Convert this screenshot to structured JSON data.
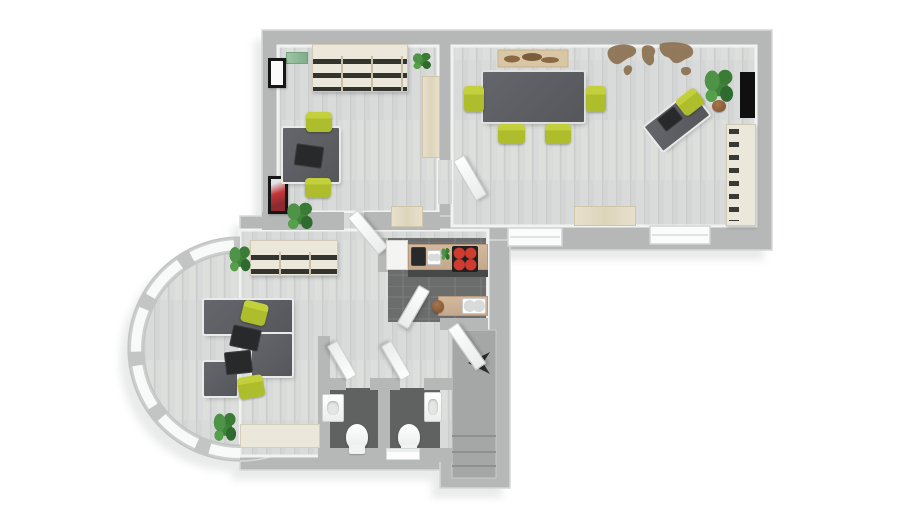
{
  "palette": {
    "bg": "#ffffff",
    "shadow": "#e9eaea",
    "wall": "#b6b8b7",
    "wall-edge": "#d7d8d7",
    "floor": "#d9dbda",
    "floor-stripe": "#cfd1d0",
    "dark-floor": "#6b6d6d",
    "bath-floor": "#606262",
    "stair": "#a5a7a6",
    "desk": "#55575b",
    "desk-rim": "#e9eaea",
    "lime": "#aebd2c",
    "cream": "#ebe7da",
    "wood": "#ddd4bb",
    "slot": "#34342e",
    "map": "#8b6f4e",
    "red": "#b03236",
    "tan": "#c5a98c",
    "stove": "#202022",
    "burner": "#cf3b2f",
    "green": "#3f8539",
    "pot": "#7a4e2d",
    "door": "#f6f7f7"
  },
  "scene": {
    "furniture": [
      {
        "name": "office1-wall-shelf",
        "cls": "binder-shelf",
        "x": 312,
        "y": 44,
        "w": 96,
        "h": 48
      },
      {
        "name": "office1-wall-plant-left",
        "cls": "wallgreen",
        "x": 286,
        "y": 52,
        "w": 22,
        "h": 12
      },
      {
        "name": "office1-wall-plant-right",
        "cls": "plant",
        "x": 410,
        "y": 50,
        "w": 24,
        "h": 22
      },
      {
        "name": "office1-frame-top",
        "cls": "frame",
        "x": 268,
        "y": 58,
        "w": 18,
        "h": 30
      },
      {
        "name": "office1-frame-bottom",
        "cls": "frame frame-red",
        "x": 268,
        "y": 176,
        "w": 20,
        "h": 38
      },
      {
        "name": "office1-cabinet",
        "cls": "wood",
        "x": 422,
        "y": 76,
        "w": 18,
        "h": 82
      },
      {
        "name": "office1-desk",
        "cls": "desk",
        "x": 283,
        "y": 128,
        "w": 56,
        "h": 54
      },
      {
        "name": "office1-desk-monitor",
        "cls": "laptop",
        "x": 296,
        "y": 146,
        "w": 26,
        "h": 20,
        "rot": 8
      },
      {
        "name": "office1-chair-top",
        "cls": "chair",
        "x": 306,
        "y": 112,
        "w": 26,
        "h": 20
      },
      {
        "name": "office1-chair-bottom",
        "cls": "chair",
        "x": 305,
        "y": 178,
        "w": 26,
        "h": 20
      },
      {
        "name": "office1-plant",
        "cls": "plant",
        "x": 283,
        "y": 198,
        "w": 34,
        "h": 36
      },
      {
        "name": "office1-door",
        "cls": "door",
        "x": 346,
        "y": 214,
        "w": 13,
        "h": 48,
        "rot": -40
      },
      {
        "name": "conference-table",
        "cls": "desk table",
        "x": 483,
        "y": 72,
        "w": 101,
        "h": 50
      },
      {
        "name": "conference-chair-left",
        "cls": "chair",
        "x": 464,
        "y": 86,
        "w": 20,
        "h": 26
      },
      {
        "name": "conference-chair-right",
        "cls": "chair",
        "x": 586,
        "y": 86,
        "w": 20,
        "h": 26
      },
      {
        "name": "conference-chair-bottom1",
        "cls": "chair",
        "x": 498,
        "y": 124,
        "w": 27,
        "h": 20
      },
      {
        "name": "conference-chair-bottom2",
        "cls": "chair",
        "x": 545,
        "y": 124,
        "w": 26,
        "h": 20
      },
      {
        "name": "conference-desk",
        "cls": "desk",
        "x": 648,
        "y": 106,
        "w": 58,
        "h": 30,
        "rot": -38
      },
      {
        "name": "conference-desk-laptop",
        "cls": "laptop",
        "x": 660,
        "y": 112,
        "w": 20,
        "h": 14,
        "rot": -38
      },
      {
        "name": "conference-desk-chair",
        "cls": "chair",
        "x": 678,
        "y": 92,
        "w": 24,
        "h": 20,
        "rot": -38
      },
      {
        "name": "conference-plant",
        "cls": "plant",
        "x": 700,
        "y": 64,
        "w": 38,
        "h": 44
      },
      {
        "name": "conference-plant-pot",
        "cls": "pot",
        "x": 712,
        "y": 100,
        "w": 14,
        "h": 12
      },
      {
        "name": "conference-art-red",
        "cls": "frame-redart",
        "x": 740,
        "y": 72,
        "w": 15,
        "h": 46
      },
      {
        "name": "conference-credenza",
        "cls": "binder-shelf-v",
        "x": 726,
        "y": 124,
        "w": 30,
        "h": 102
      },
      {
        "name": "conference-sideboard",
        "cls": "wood",
        "x": 574,
        "y": 206,
        "w": 62,
        "h": 20
      },
      {
        "name": "conference-door",
        "cls": "door",
        "x": 452,
        "y": 158,
        "w": 13,
        "h": 46,
        "rot": -30
      },
      {
        "name": "hall-sideboard",
        "cls": "wood",
        "x": 391,
        "y": 206,
        "w": 32,
        "h": 21
      },
      {
        "name": "kitchen-fridge",
        "cls": "appliance",
        "x": 386,
        "y": 240,
        "w": 22,
        "h": 30
      },
      {
        "name": "kitchen-counter",
        "cls": "counter",
        "x": 408,
        "y": 244,
        "w": 80,
        "h": 26
      },
      {
        "name": "kitchen-counter-front",
        "cls": "counter-front",
        "x": 408,
        "y": 270,
        "w": 80,
        "h": 7
      },
      {
        "name": "kitchen-coffee-machine",
        "cls": "laptop",
        "x": 412,
        "y": 248,
        "w": 13,
        "h": 17
      },
      {
        "name": "kitchen-bowls",
        "cls": "sink",
        "x": 427,
        "y": 250,
        "w": 14,
        "h": 15
      },
      {
        "name": "kitchen-herb-plant",
        "cls": "plant",
        "x": 440,
        "y": 246,
        "w": 11,
        "h": 16
      },
      {
        "name": "kitchen-stove",
        "cls": "stove",
        "x": 452,
        "y": 246,
        "w": 26,
        "h": 26
      },
      {
        "name": "kitchen-sink-counter",
        "cls": "counter",
        "x": 438,
        "y": 296,
        "w": 50,
        "h": 20
      },
      {
        "name": "kitchen-sink",
        "cls": "sink",
        "x": 462,
        "y": 298,
        "w": 24,
        "h": 16
      },
      {
        "name": "kitchen-jar",
        "cls": "pot",
        "x": 432,
        "y": 300,
        "w": 12,
        "h": 13
      },
      {
        "name": "kitchen-door",
        "cls": "door",
        "x": 418,
        "y": 288,
        "w": 13,
        "h": 44,
        "rot": 30
      },
      {
        "name": "bath1-sink",
        "cls": "sink-unit",
        "x": 322,
        "y": 394,
        "w": 22,
        "h": 28
      },
      {
        "name": "bath1-toilet",
        "cls": "toilet",
        "x": 346,
        "y": 424,
        "w": 22,
        "h": 26
      },
      {
        "name": "bath1-door",
        "cls": "door",
        "x": 346,
        "y": 378,
        "w": 12,
        "h": 40,
        "rot": 150
      },
      {
        "name": "bath2-sink",
        "cls": "sink-unit",
        "x": 424,
        "y": 392,
        "w": 18,
        "h": 30
      },
      {
        "name": "bath2-toilet",
        "cls": "toilet",
        "x": 398,
        "y": 424,
        "w": 22,
        "h": 26
      },
      {
        "name": "bath2-door",
        "cls": "door",
        "x": 400,
        "y": 378,
        "w": 12,
        "h": 40,
        "rot": 150
      },
      {
        "name": "bath-bench",
        "cls": "mat",
        "x": 386,
        "y": 448,
        "w": 34,
        "h": 12
      },
      {
        "name": "lounge-sideboard-top",
        "cls": "binder-shelf",
        "x": 250,
        "y": 240,
        "w": 88,
        "h": 36
      },
      {
        "name": "lounge-plant-top",
        "cls": "plant",
        "x": 226,
        "y": 242,
        "w": 28,
        "h": 34
      },
      {
        "name": "lounge-desk-main",
        "cls": "desk",
        "x": 204,
        "y": 300,
        "w": 88,
        "h": 34
      },
      {
        "name": "lounge-desk-right",
        "cls": "desk",
        "x": 252,
        "y": 334,
        "w": 40,
        "h": 42
      },
      {
        "name": "lounge-desk-left",
        "cls": "desk",
        "x": 204,
        "y": 362,
        "w": 33,
        "h": 34
      },
      {
        "name": "lounge-laptop1",
        "cls": "laptop",
        "x": 232,
        "y": 328,
        "w": 27,
        "h": 20,
        "rot": 12
      },
      {
        "name": "lounge-laptop2",
        "cls": "laptop",
        "x": 226,
        "y": 352,
        "w": 25,
        "h": 21,
        "rot": -6
      },
      {
        "name": "lounge-chair-top",
        "cls": "chair",
        "x": 242,
        "y": 302,
        "w": 25,
        "h": 22,
        "rot": 14
      },
      {
        "name": "lounge-chair-bottom",
        "cls": "chair",
        "x": 238,
        "y": 376,
        "w": 26,
        "h": 22,
        "rot": -10
      },
      {
        "name": "lounge-plant-bottom",
        "cls": "plant",
        "x": 210,
        "y": 408,
        "w": 30,
        "h": 38
      },
      {
        "name": "lounge-sideboard-bottom",
        "cls": "cream",
        "x": 240,
        "y": 424,
        "w": 80,
        "h": 24
      },
      {
        "name": "stair-door",
        "cls": "door",
        "x": 446,
        "y": 326,
        "w": 13,
        "h": 50,
        "rot": -35
      }
    ]
  }
}
